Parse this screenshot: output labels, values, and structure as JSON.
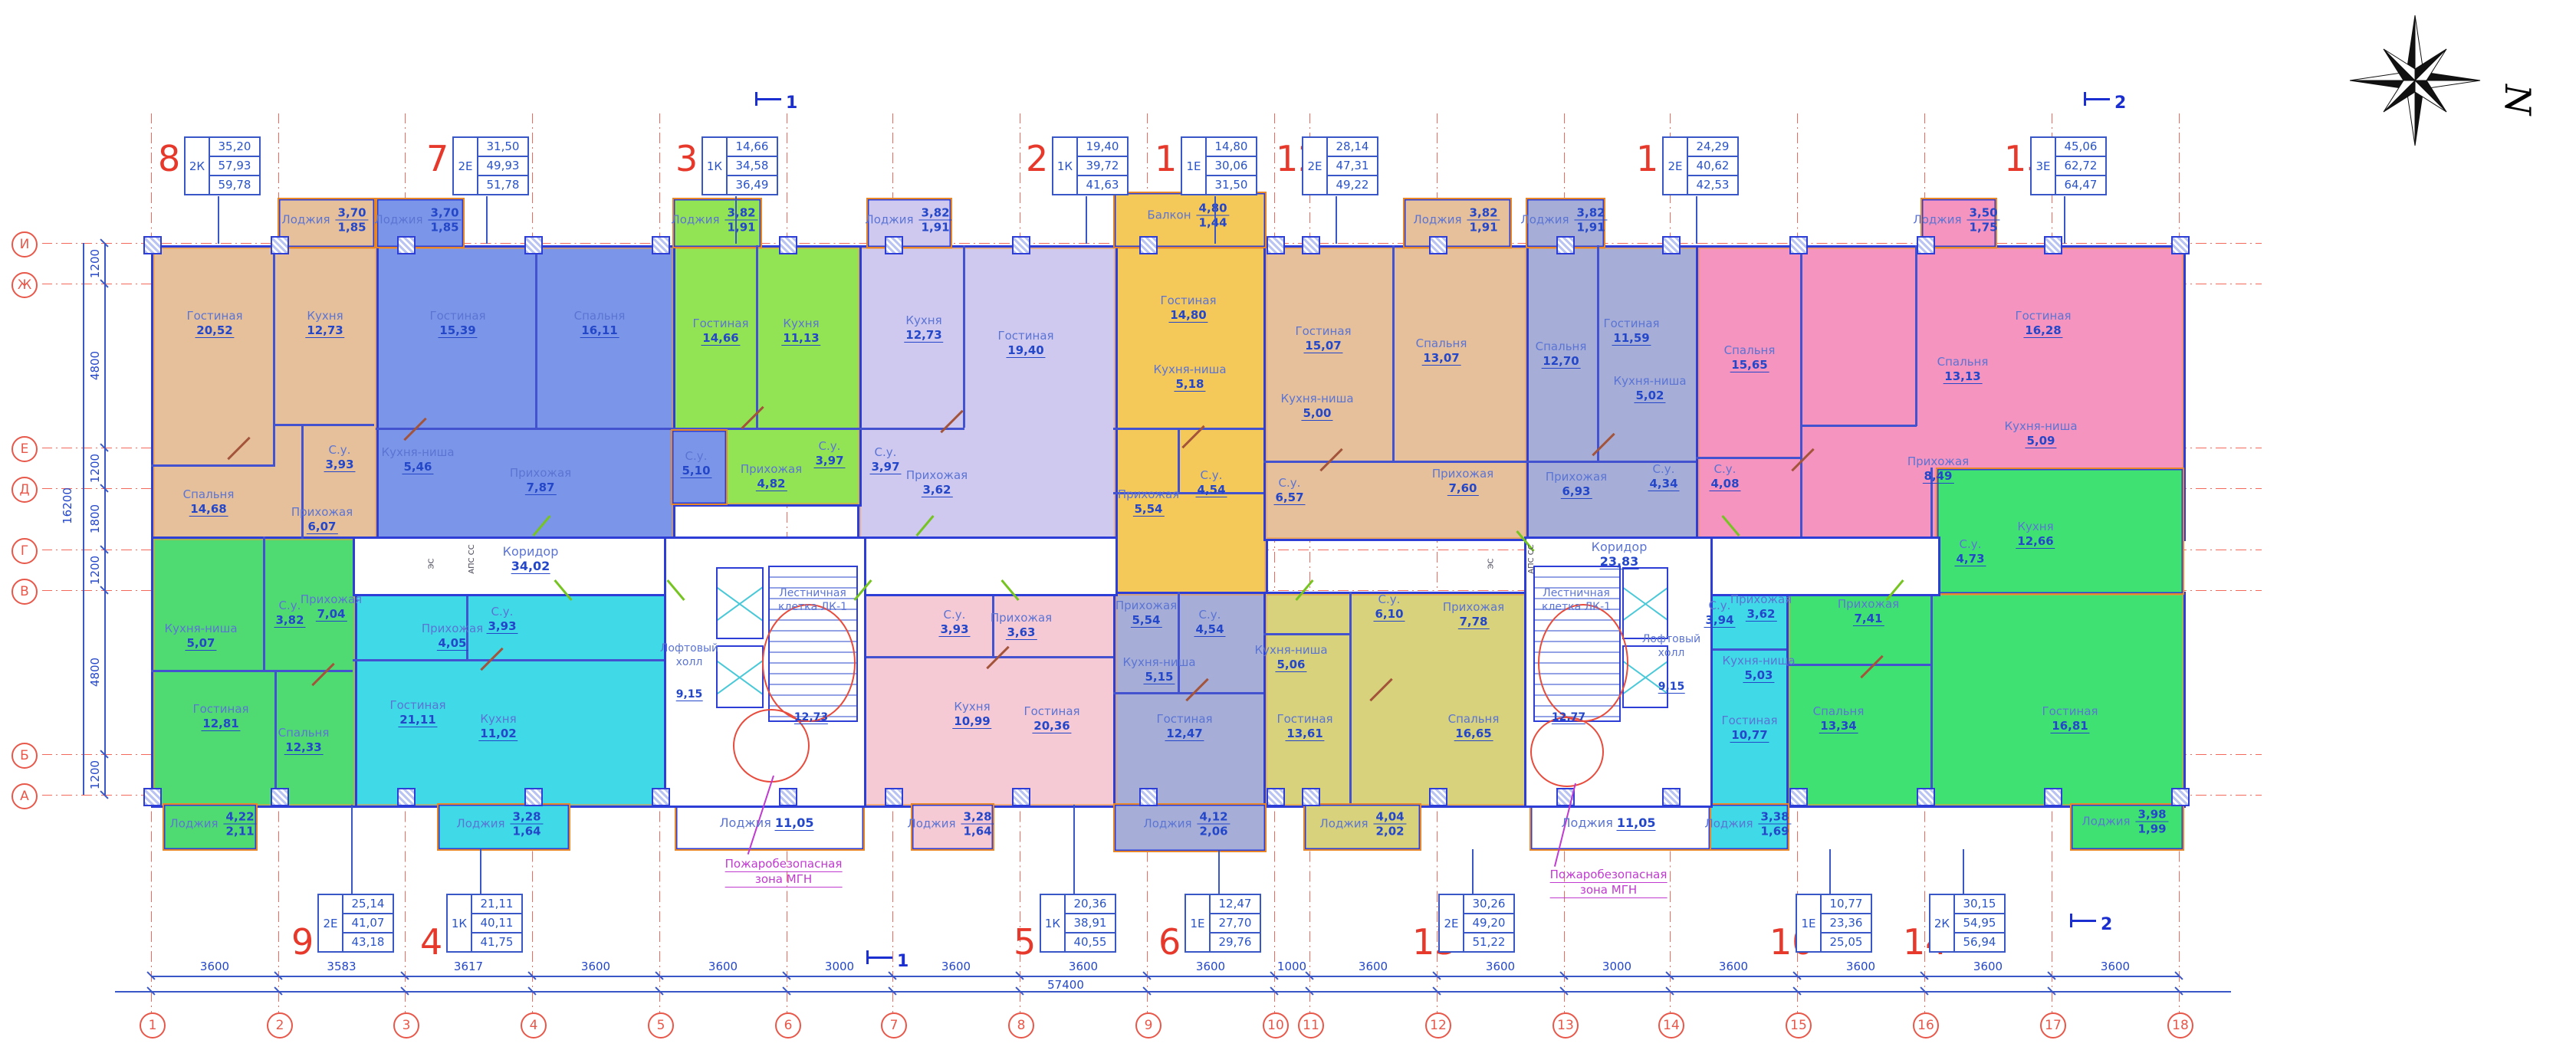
{
  "compass_n": "N",
  "axis": {
    "columns": [
      "1",
      "2",
      "3",
      "4",
      "5",
      "6",
      "7",
      "8",
      "9",
      "10",
      "11",
      "12",
      "13",
      "14",
      "15",
      "16",
      "17",
      "18"
    ],
    "rows": [
      "И",
      "Ж",
      "Е",
      "Д",
      "Г",
      "В",
      "Б",
      "А"
    ]
  },
  "dimensions": {
    "bottom_segments": [
      "3600",
      "3583",
      "3617",
      "3600",
      "3600",
      "3000",
      "3600",
      "3600",
      "3600",
      "1000",
      "3600",
      "3600",
      "3000",
      "3600",
      "3600",
      "3600",
      "3600"
    ],
    "bottom_total": "57400",
    "left_segments": [
      "1200",
      "4800",
      "1200",
      "1800",
      "1200",
      "4800",
      "1200"
    ],
    "left_total": "16200"
  },
  "section_markers": [
    "1",
    "1",
    "2",
    "2"
  ],
  "corridors": [
    {
      "name": "Коридор",
      "area": "34,02"
    },
    {
      "name": "Коридор",
      "area": "23,83"
    }
  ],
  "cores": [
    {
      "stair_line1": "Лестничная",
      "stair_line2": "клетка ЛК-1",
      "stair_area": "12,73",
      "hall_line1": "Лофтовый",
      "hall_line2": "холл",
      "hall_area": "9,15",
      "loggia_name": "Лоджия",
      "loggia_area": "11,05"
    },
    {
      "stair_line1": "Лестничная",
      "stair_line2": "клетка ЛК-1",
      "stair_area": "12,77",
      "hall_line1": "Лофтовый",
      "hall_line2": "холл",
      "hall_area": "9,15",
      "loggia_name": "Лоджия",
      "loggia_area": "11,05"
    }
  ],
  "fire_zone": {
    "line1": "Пожаробезопасная",
    "line2": "зона МГН"
  },
  "tech_labels": {
    "es": "ЭС",
    "aps": "АПС",
    "ss": "СС"
  },
  "apartments": [
    {
      "number": "1",
      "type": "1Е",
      "living_area": "14,80",
      "area": "30,06",
      "total_area": "31,50",
      "rooms": [
        {
          "name": "Гостиная",
          "area": "14,80"
        },
        {
          "name": "Кухня-ниша",
          "area": "5,18"
        },
        {
          "name": "С.у.",
          "area": "4,54"
        },
        {
          "name": "Прихожая",
          "area": "5,54"
        },
        {
          "name": "Балкон",
          "area": "4,80",
          "area_half": "1,44"
        }
      ]
    },
    {
      "number": "2",
      "type": "1К",
      "living_area": "19,40",
      "area": "39,72",
      "total_area": "41,63",
      "rooms": [
        {
          "name": "Гостиная",
          "area": "19,40"
        },
        {
          "name": "Кухня",
          "area": "12,73"
        },
        {
          "name": "С.у.",
          "area": "3,97"
        },
        {
          "name": "Прихожая",
          "area": "3,62"
        },
        {
          "name": "Лоджия",
          "area": "3,82",
          "area_half": "1,91"
        }
      ]
    },
    {
      "number": "3",
      "type": "1К",
      "living_area": "14,66",
      "area": "34,58",
      "total_area": "36,49",
      "rooms": [
        {
          "name": "Гостиная",
          "area": "14,66"
        },
        {
          "name": "Кухня",
          "area": "11,13"
        },
        {
          "name": "С.у.",
          "area": "3,97"
        },
        {
          "name": "Прихожая",
          "area": "4,82"
        },
        {
          "name": "Лоджия",
          "area": "3,82",
          "area_half": "1,91"
        }
      ]
    },
    {
      "number": "4",
      "type": "1К",
      "living_area": "21,11",
      "area": "40,11",
      "total_area": "41,75",
      "rooms": [
        {
          "name": "Гостиная",
          "area": "21,11"
        },
        {
          "name": "Кухня",
          "area": "11,02"
        },
        {
          "name": "С.у.",
          "area": "3,93"
        },
        {
          "name": "Прихожая",
          "area": "4,05"
        },
        {
          "name": "Лоджия",
          "area": "3,28",
          "area_half": "1,64"
        }
      ]
    },
    {
      "number": "5",
      "type": "1К",
      "living_area": "20,36",
      "area": "38,91",
      "total_area": "40,55",
      "rooms": [
        {
          "name": "Гостиная",
          "area": "20,36"
        },
        {
          "name": "Кухня",
          "area": "10,99"
        },
        {
          "name": "С.у.",
          "area": "3,93"
        },
        {
          "name": "Прихожая",
          "area": "3,63"
        },
        {
          "name": "Лоджия",
          "area": "3,28",
          "area_half": "1,64"
        }
      ]
    },
    {
      "number": "6",
      "type": "1Е",
      "living_area": "12,47",
      "area": "27,70",
      "total_area": "29,76",
      "rooms": [
        {
          "name": "Гостиная",
          "area": "12,47"
        },
        {
          "name": "Кухня-ниша",
          "area": "5,15"
        },
        {
          "name": "С.у.",
          "area": "4,54"
        },
        {
          "name": "Прихожая",
          "area": "5,54"
        },
        {
          "name": "Лоджия",
          "area": "4,12",
          "area_half": "2,06"
        }
      ]
    },
    {
      "number": "7",
      "type": "2Е",
      "living_area": "31,50",
      "area": "49,93",
      "total_area": "51,78",
      "rooms": [
        {
          "name": "Гостиная",
          "area": "15,39"
        },
        {
          "name": "Спальня",
          "area": "16,11"
        },
        {
          "name": "Кухня-ниша",
          "area": "5,46"
        },
        {
          "name": "С.у.",
          "area": "5,10"
        },
        {
          "name": "Прихожая",
          "area": "7,87"
        },
        {
          "name": "Лоджия",
          "area": "3,70",
          "area_half": "1,85"
        }
      ]
    },
    {
      "number": "8",
      "type": "2К",
      "living_area": "35,20",
      "area": "57,93",
      "total_area": "59,78",
      "rooms": [
        {
          "name": "Гостиная",
          "area": "20,52"
        },
        {
          "name": "Спальня",
          "area": "14,68"
        },
        {
          "name": "Кухня",
          "area": "12,73"
        },
        {
          "name": "С.у.",
          "area": "3,93"
        },
        {
          "name": "Прихожая",
          "area": "6,07"
        },
        {
          "name": "Лоджия",
          "area": "3,70",
          "area_half": "1,85"
        }
      ]
    },
    {
      "number": "9",
      "type": "2Е",
      "living_area": "25,14",
      "area": "41,07",
      "total_area": "43,18",
      "rooms": [
        {
          "name": "Гостиная",
          "area": "12,81"
        },
        {
          "name": "Спальня",
          "area": "12,33"
        },
        {
          "name": "Кухня-ниша",
          "area": "5,07"
        },
        {
          "name": "С.у.",
          "area": "3,82"
        },
        {
          "name": "Прихожая",
          "area": "7,04"
        },
        {
          "name": "Лоджия",
          "area": "4,22",
          "area_half": "2,11"
        }
      ]
    },
    {
      "number": "10",
      "type": "1Е",
      "living_area": "10,77",
      "area": "23,36",
      "total_area": "25,05",
      "rooms": [
        {
          "name": "Гостиная",
          "area": "10,77"
        },
        {
          "name": "Кухня-ниша",
          "area": "5,03"
        },
        {
          "name": "С.у.",
          "area": "3,94"
        },
        {
          "name": "Прихожая",
          "area": "3,62"
        },
        {
          "name": "Лоджия",
          "area": "3,38",
          "area_half": "1,69"
        }
      ]
    },
    {
      "number": "11",
      "type": "2Е",
      "living_area": "24,29",
      "area": "40,62",
      "total_area": "42,53",
      "rooms": [
        {
          "name": "Гостиная",
          "area": "11,59"
        },
        {
          "name": "Спальня",
          "area": "12,70"
        },
        {
          "name": "Кухня-ниша",
          "area": "5,02"
        },
        {
          "name": "С.у.",
          "area": "4,34"
        },
        {
          "name": "Прихожая",
          "area": "6,93"
        },
        {
          "name": "Лоджия",
          "area": "3,82",
          "area_half": "1,91"
        }
      ]
    },
    {
      "number": "12",
      "type": "2Е",
      "living_area": "28,14",
      "area": "47,31",
      "total_area": "49,22",
      "rooms": [
        {
          "name": "Гостиная",
          "area": "15,07"
        },
        {
          "name": "Спальня",
          "area": "13,07"
        },
        {
          "name": "Кухня-ниша",
          "area": "5,00"
        },
        {
          "name": "С.у.",
          "area": "6,57"
        },
        {
          "name": "Прихожая",
          "area": "7,60"
        },
        {
          "name": "Лоджия",
          "area": "3,82",
          "area_half": "1,91"
        }
      ]
    },
    {
      "number": "13",
      "type": "2Е",
      "living_area": "30,26",
      "area": "49,20",
      "total_area": "51,22",
      "rooms": [
        {
          "name": "Гостиная",
          "area": "13,61"
        },
        {
          "name": "Спальня",
          "area": "16,65"
        },
        {
          "name": "Кухня-ниша",
          "area": "5,06"
        },
        {
          "name": "С.у.",
          "area": "6,10"
        },
        {
          "name": "Прихожая",
          "area": "7,78"
        },
        {
          "name": "Лоджия",
          "area": "4,04",
          "area_half": "2,02"
        }
      ]
    },
    {
      "number": "14",
      "type": "2К",
      "living_area": "30,15",
      "area": "54,95",
      "total_area": "56,94",
      "rooms": [
        {
          "name": "Гостиная",
          "area": "16,81"
        },
        {
          "name": "Спальня",
          "area": "13,34"
        },
        {
          "name": "Кухня",
          "area": "12,66"
        },
        {
          "name": "С.у.",
          "area": "4,73"
        },
        {
          "name": "Прихожая",
          "area": "7,41"
        },
        {
          "name": "Лоджия",
          "area": "3,98",
          "area_half": "1,99"
        }
      ]
    },
    {
      "number": "15",
      "type": "3Е",
      "living_area": "45,06",
      "area": "62,72",
      "total_area": "64,47",
      "rooms": [
        {
          "name": "Гостиная",
          "area": "16,28"
        },
        {
          "name": "Спальня",
          "area": "15,65"
        },
        {
          "name": "Спальня",
          "area": "13,13"
        },
        {
          "name": "Кухня-ниша",
          "area": "5,09"
        },
        {
          "name": "С.у.",
          "area": "4,08"
        },
        {
          "name": "Прихожая",
          "area": "8,49"
        },
        {
          "name": "Лоджия",
          "area": "3,50",
          "area_half": "1,75"
        }
      ]
    }
  ]
}
